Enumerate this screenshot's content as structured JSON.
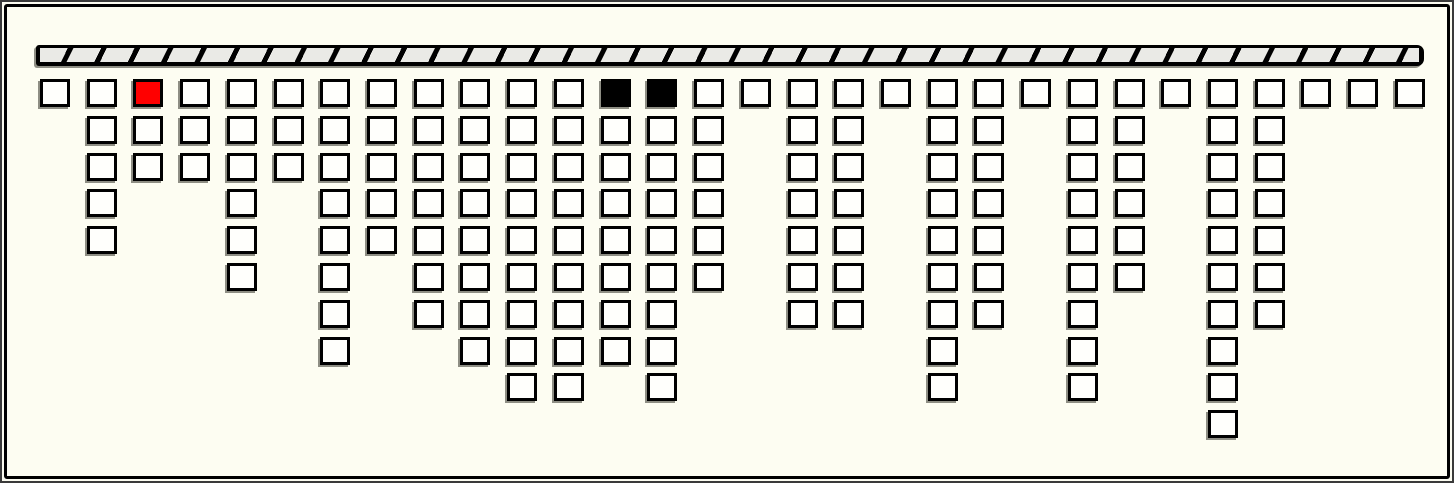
{
  "window": {
    "background_color": "#FDFDF2",
    "frame_color": "#000000",
    "outer_edge_color": "#3A3A3A"
  },
  "beam": {
    "fill_color": "#000000",
    "segment_color": "#EAEAE6",
    "segment_period_px": 33,
    "shadow_color": "#8E8E84"
  },
  "board": {
    "columns": 30,
    "max_rows": 10,
    "total_blocks": 159,
    "column_heights": [
      1,
      5,
      3,
      3,
      6,
      3,
      8,
      5,
      7,
      8,
      9,
      9,
      8,
      9,
      6,
      1,
      7,
      7,
      1,
      9,
      7,
      1,
      9,
      6,
      1,
      10,
      7,
      1,
      1,
      1
    ],
    "colors": {
      "block_fill": "#FFFFFC",
      "block_border": "#000000",
      "block_shadow": "#8E8E84",
      "highlight_red": "#FF0000",
      "highlight_black": "#000000"
    },
    "special_blocks": [
      {
        "column": 3,
        "row": 1,
        "color_key": "highlight_red"
      },
      {
        "column": 13,
        "row": 1,
        "color_key": "highlight_black"
      },
      {
        "column": 14,
        "row": 1,
        "color_key": "highlight_black"
      }
    ],
    "grid": {
      "origin_x": 33,
      "origin_y": 72,
      "col_spacing": 46.72,
      "row_spacing": 36.8,
      "block_width": 30,
      "block_height": 28
    }
  }
}
